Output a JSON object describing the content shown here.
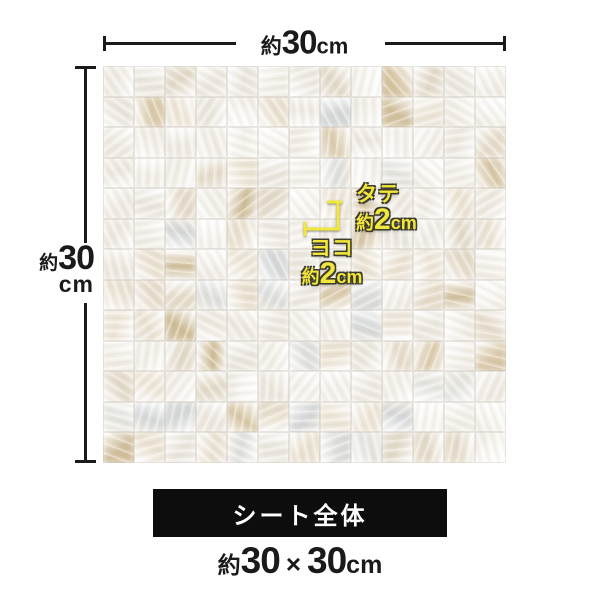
{
  "colors": {
    "accent_yellow": "#f2e73c",
    "banner_bg": "#0d0d0d",
    "line_dark": "#1a1a1a",
    "background": "#ffffff"
  },
  "top_dimension": {
    "approx": "約",
    "value": "30",
    "unit": "cm"
  },
  "left_dimension": {
    "approx": "約",
    "value": "30",
    "unit": "cm"
  },
  "tile_dimension_vertical": {
    "label": "タテ",
    "approx": "約",
    "value": "2",
    "unit": "cm"
  },
  "tile_dimension_horizontal": {
    "label": "ヨコ",
    "approx": "約",
    "value": "2",
    "unit": "cm"
  },
  "footer": {
    "banner_label": "シート全体",
    "size_approx": "約",
    "size_width": "30",
    "size_separator": "×",
    "size_height": "30",
    "size_unit": "cm"
  },
  "mosaic": {
    "rows": 13,
    "cols": 13,
    "palette_white": [
      "#faf8f4",
      "#f4f1ea",
      "#efeae1",
      "#f6f3ee",
      "#ece8df",
      "#f1ede6"
    ],
    "palette_cream": [
      "#ece3d3",
      "#e7ddcc",
      "#efe7d9",
      "#e3dac9"
    ],
    "palette_amber": [
      "#d8c7a5",
      "#cfbc95",
      "#dccbad",
      "#d2c09c"
    ],
    "palette_cool": [
      "#dfe1df",
      "#d6d9da",
      "#e6e6e2"
    ]
  }
}
